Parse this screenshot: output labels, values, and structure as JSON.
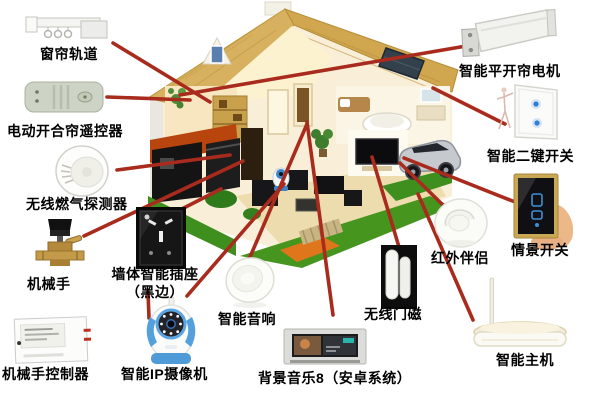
{
  "diagram": {
    "center_illustration": "smart-home-cutaway-house",
    "connector_color": "#a82b1d",
    "label_color": "#000000"
  },
  "devices": [
    {
      "id": "curtain-track",
      "label": "窗帘轨道"
    },
    {
      "id": "curtain-remote",
      "label": "电动开合帘遥控器"
    },
    {
      "id": "gas-detector",
      "label": "无线燃气探测器"
    },
    {
      "id": "manipulator",
      "label": "机械手"
    },
    {
      "id": "manipulator-controller",
      "label": "机械手控制器"
    },
    {
      "id": "wall-socket",
      "label": "墙体智能插座",
      "label2": "（黑边）"
    },
    {
      "id": "ip-camera",
      "label": "智能IP摄像机"
    },
    {
      "id": "smart-speaker",
      "label": "智能音响"
    },
    {
      "id": "bg-music-panel",
      "label": "背景音乐8（安卓系统）"
    },
    {
      "id": "door-magnet",
      "label": "无线门磁"
    },
    {
      "id": "curtain-motor",
      "label": "智能平开帘电机"
    },
    {
      "id": "two-key-switch",
      "label": "智能二键开关"
    },
    {
      "id": "scene-switch",
      "label": "情景开关"
    },
    {
      "id": "infrared-companion",
      "label": "红外伴侣"
    },
    {
      "id": "smart-host",
      "label": "智能主机"
    }
  ]
}
